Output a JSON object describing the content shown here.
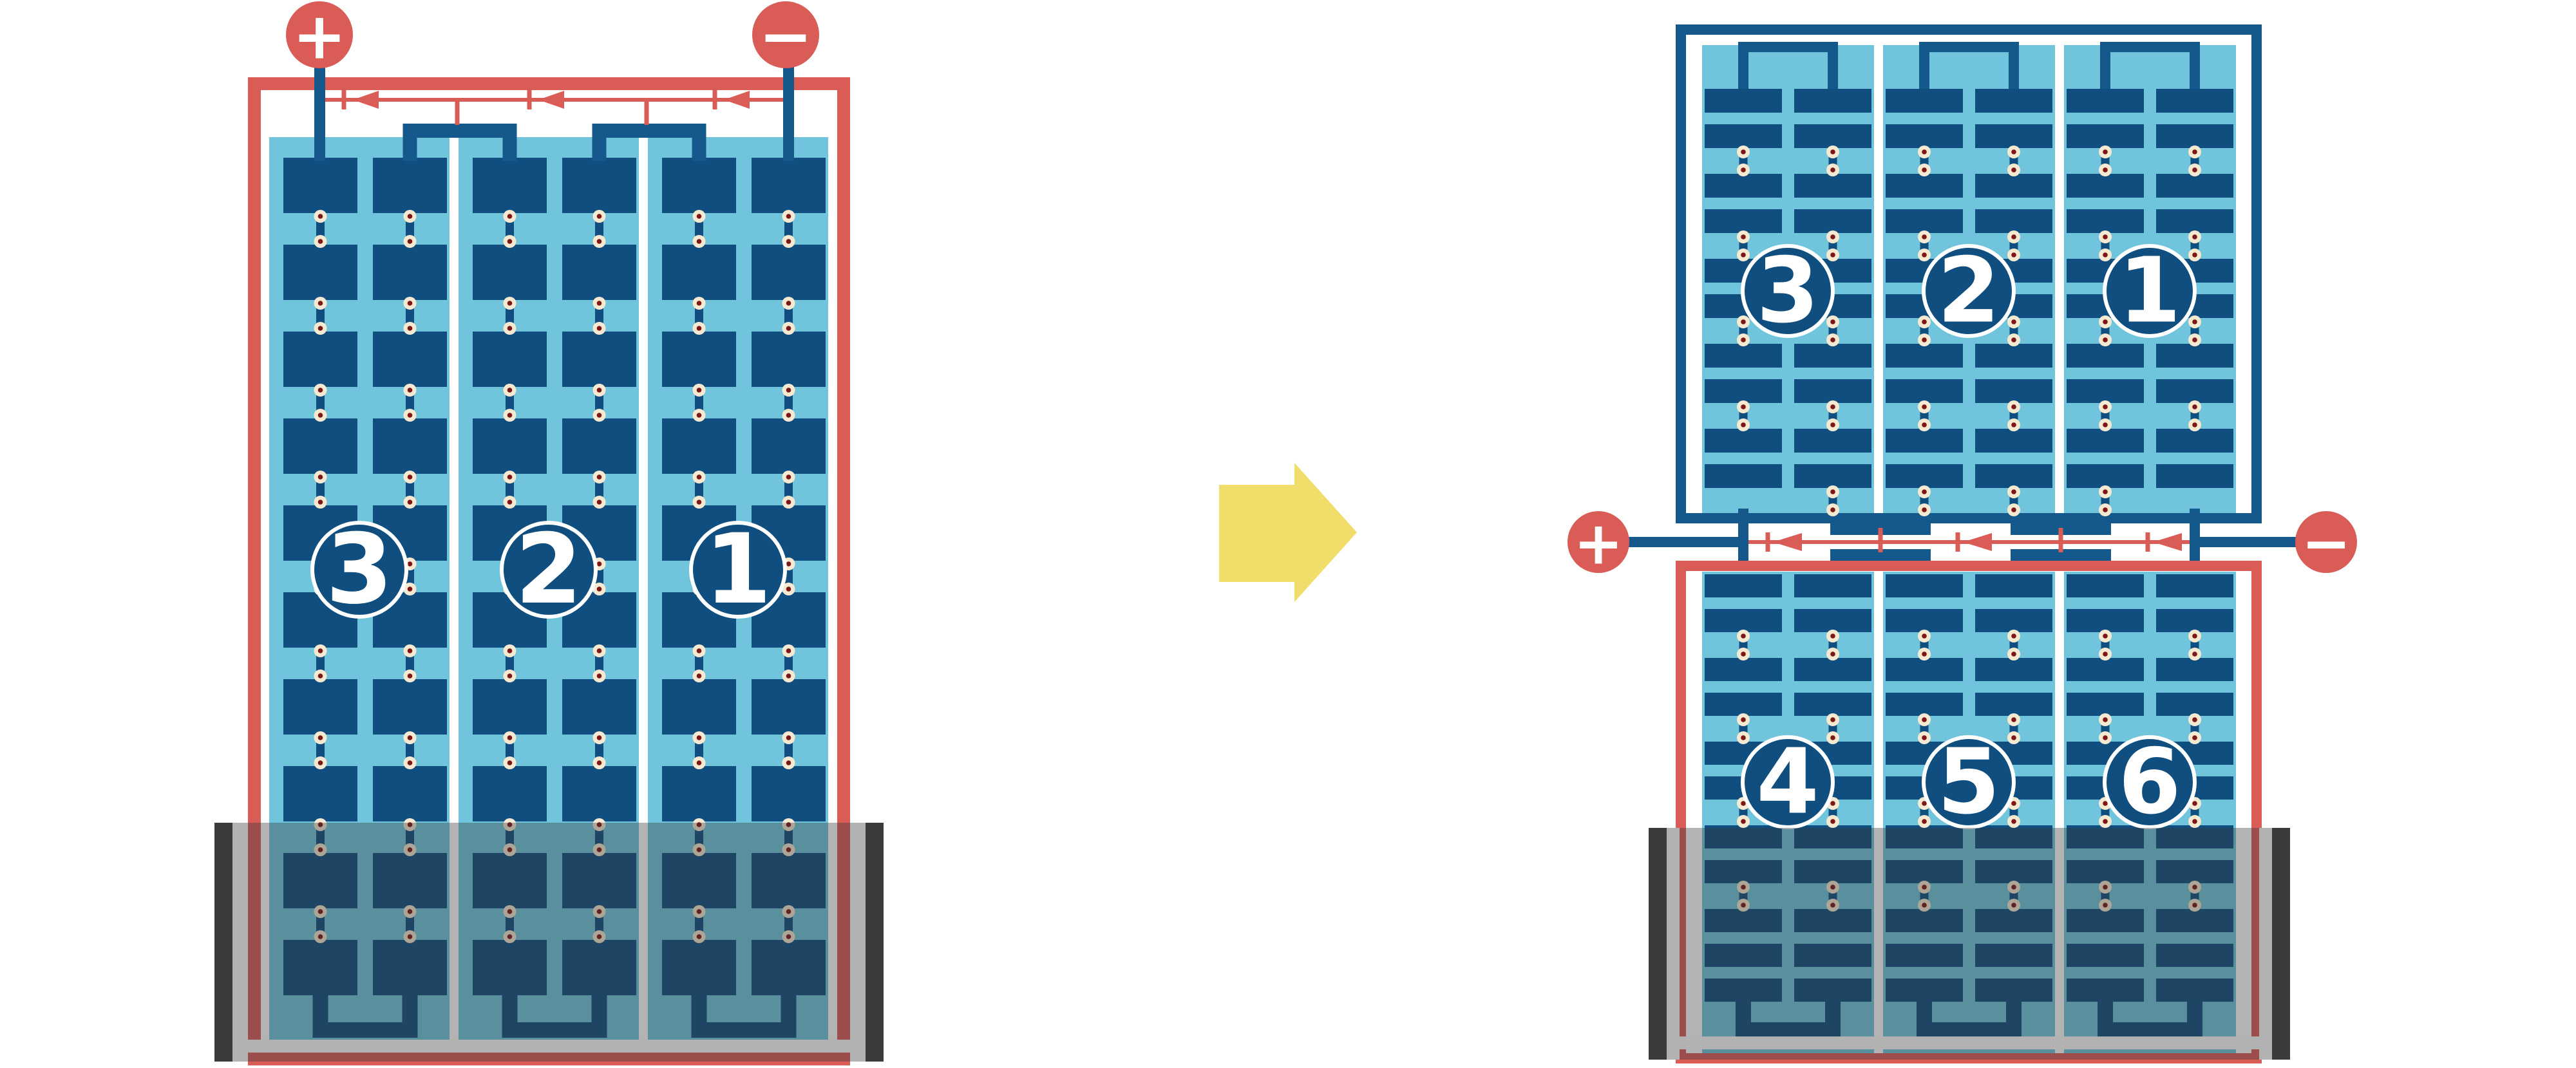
{
  "colors": {
    "red": "#D95C57",
    "frame_blue": "#15588C",
    "plate_blue": "#0F4E7F",
    "light_blue": "#70C5DC",
    "cream": "#F5E9D1",
    "dot_red": "#7D1715",
    "yellow": "#F1DD6A",
    "tray_border": "#B2B2B2",
    "tray_dark": "#3B3B3B",
    "overlay": "rgba(55,55,55,0.38)"
  },
  "left_battery": {
    "terminal_positive": "+",
    "terminal_negative": "−",
    "cell_labels": [
      "3",
      "2",
      "1"
    ]
  },
  "transform_arrow": {
    "direction": "right"
  },
  "right_battery": {
    "terminal_positive": "+",
    "terminal_negative": "−",
    "top_block": {
      "cell_labels": [
        "3",
        "2",
        "1"
      ]
    },
    "bottom_block": {
      "cell_labels": [
        "4",
        "5",
        "6"
      ]
    }
  }
}
